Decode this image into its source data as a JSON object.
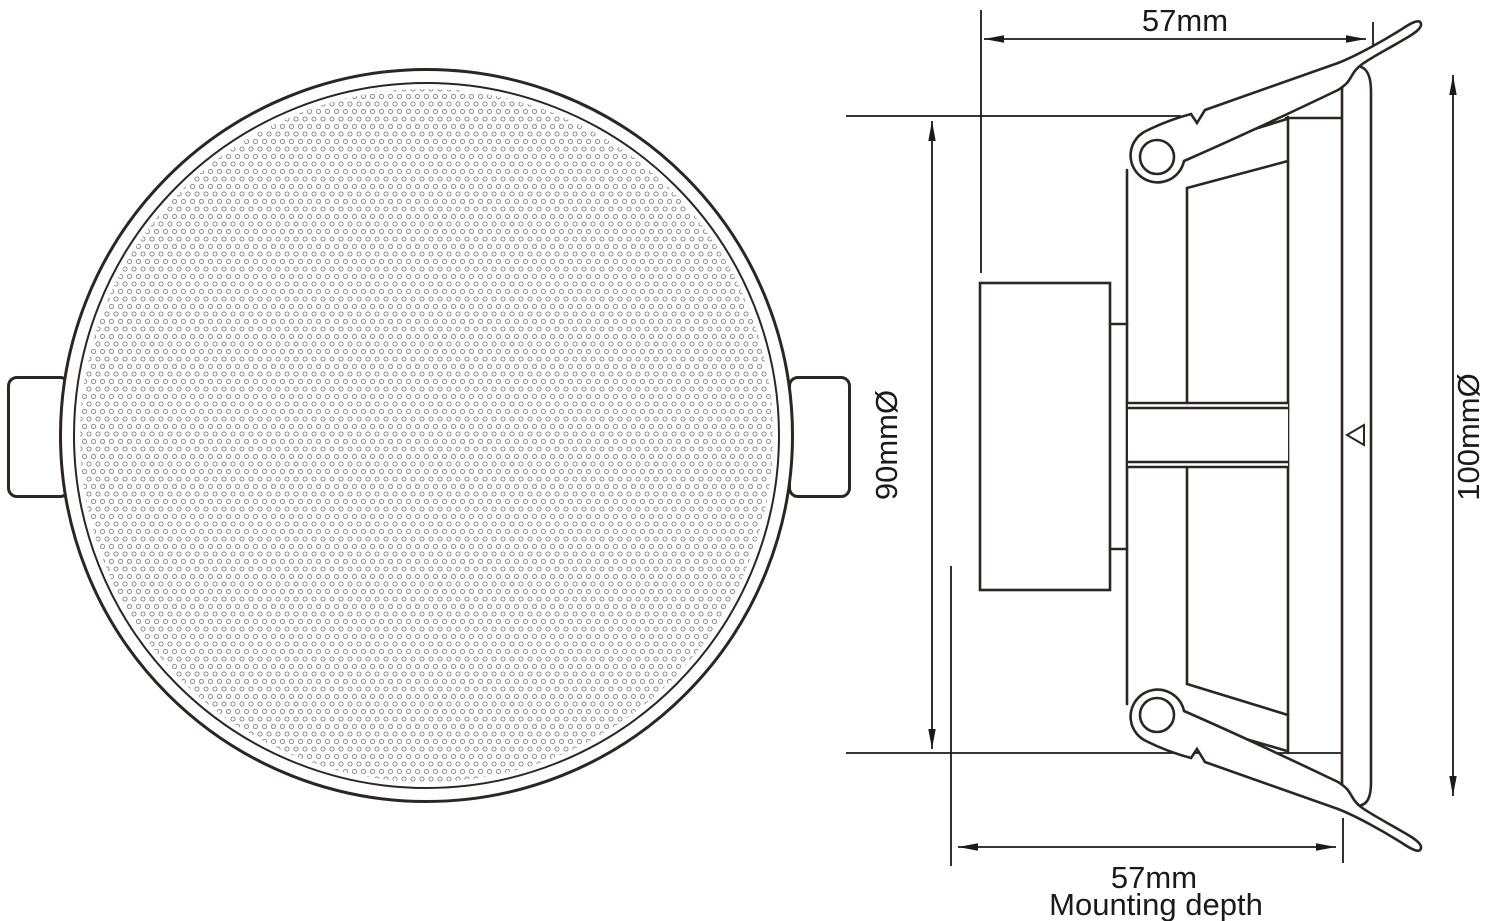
{
  "drawing": {
    "background": "#ffffff",
    "outline_color": "#2b2524",
    "dimension_color": "#1a1a1a",
    "grille_dot_color": "#8f8f8f",
    "front_view": {
      "shape": "circle-with-perforated-grille",
      "mounting_tabs": 2
    },
    "side_view": {
      "spring_clips": 2,
      "flange_marker": "left-pointing-triangle"
    }
  },
  "dimensions": {
    "top_width": {
      "label": "57mm"
    },
    "cutout_diameter": {
      "label": "90mmØ"
    },
    "outer_diameter": {
      "label": "100mmØ"
    },
    "mounting_depth": {
      "label": "57mm",
      "sublabel": "Mounting depth"
    }
  }
}
